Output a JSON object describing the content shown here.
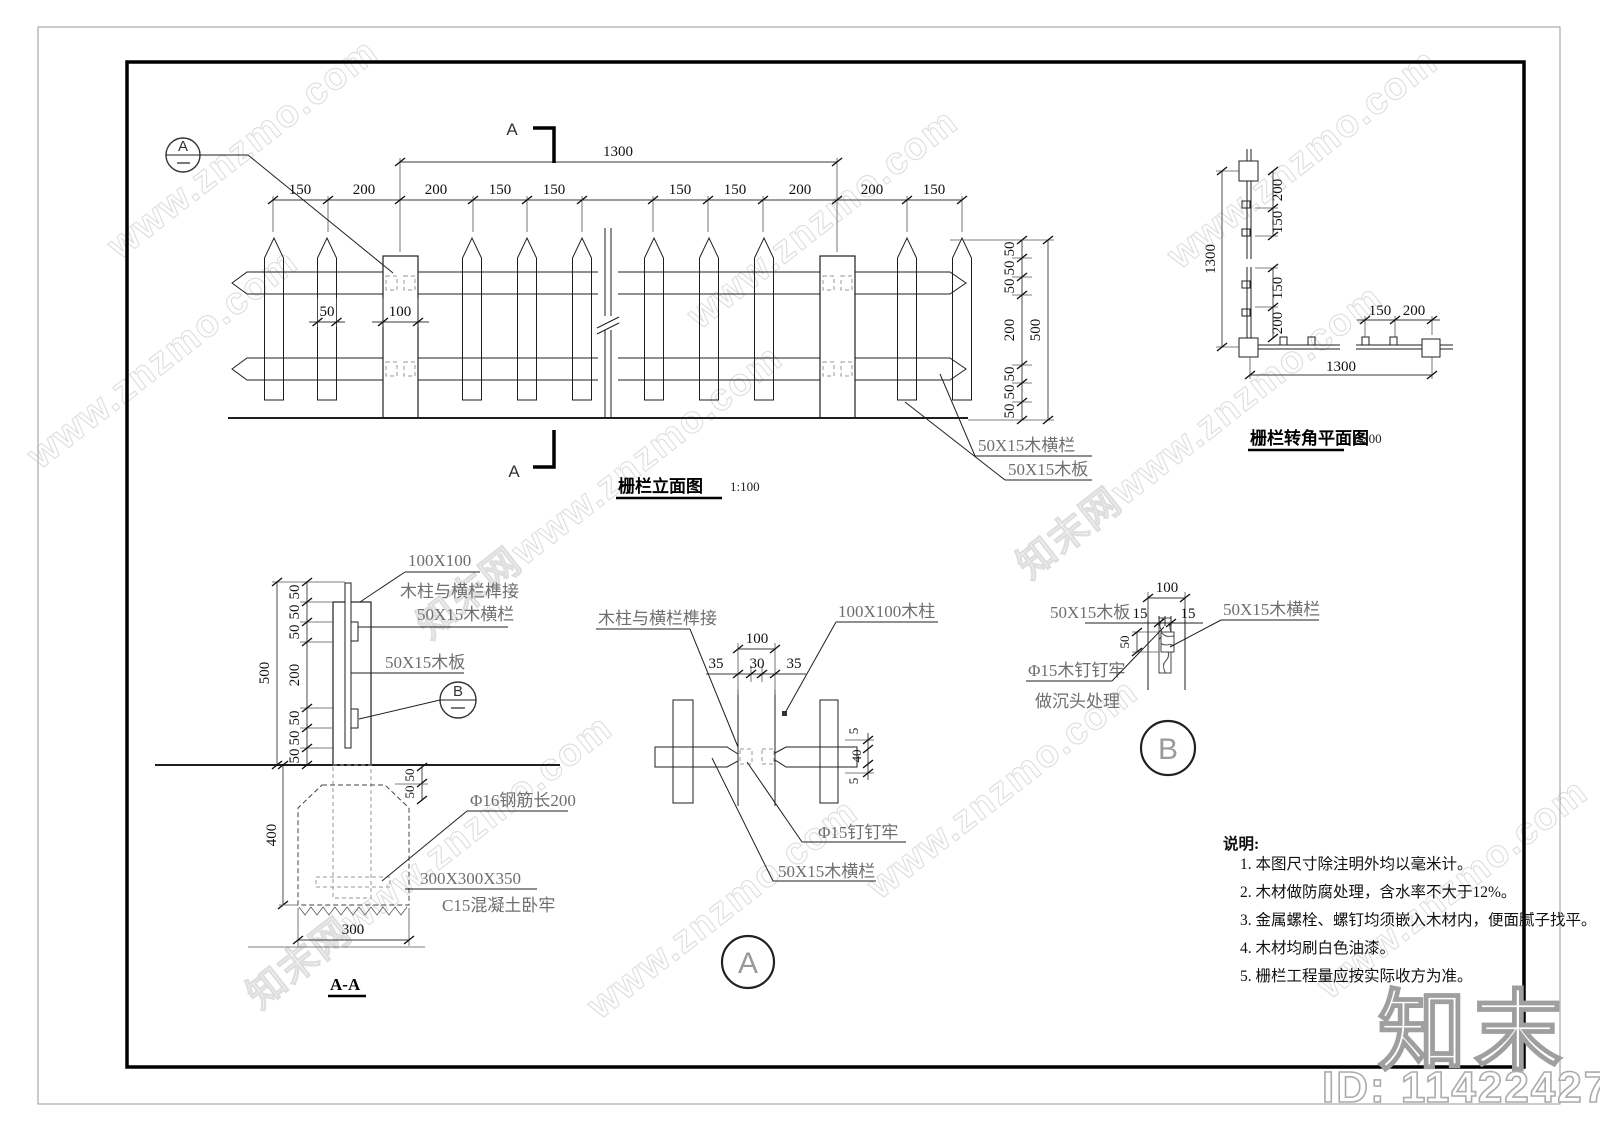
{
  "watermark": {
    "text1": "www.znzmo.com",
    "text2": "知末网www.znzmo.com",
    "logo": "知末",
    "id_label": "ID: 1142242742"
  },
  "elevation": {
    "title": "栅栏立面图",
    "scale": "1:100",
    "dim_overall_w": "1300",
    "top_dims": [
      "150",
      "200",
      "200",
      "150",
      "150",
      "150",
      "150",
      "200",
      "200",
      "150"
    ],
    "dim_picket": "50",
    "dim_post": "100",
    "side_dims": [
      "50",
      "50",
      "50",
      "200",
      "50",
      "50",
      "50"
    ],
    "dim_overall_h": "500",
    "label_rail": "50X15木横栏",
    "label_board": "50X15木板",
    "section_letter": "A",
    "callout_letter": "A",
    "callout_dash": "—"
  },
  "corner_plan": {
    "title": "栅栏转角平面图",
    "scale": "1:200",
    "dim_overall_v": "1300",
    "v_dims": [
      "200",
      "150",
      "150",
      "200"
    ],
    "h_dims": [
      "150",
      "200"
    ],
    "dim_overall_h": "1300"
  },
  "section_aa": {
    "title": "A-A",
    "side_dims": [
      "50",
      "50",
      "50",
      "200",
      "50",
      "50",
      "50"
    ],
    "dim_overall_h": "500",
    "below_dims": [
      "50",
      "50"
    ],
    "dim_depth": "400",
    "dim_width": "300",
    "label_post": "100X100",
    "label_joint": "木柱与横栏榫接",
    "label_rail": "50X15木横栏",
    "label_board": "50X15木板",
    "label_rebar": "Φ16钢筋长200",
    "label_footing_size": "300X300X350",
    "label_footing": "C15混凝土卧牢",
    "callout_letter": "B",
    "callout_dash": "—"
  },
  "detail_a": {
    "letter": "A",
    "label_joint": "木柱与横栏榫接",
    "label_post": "100X100木柱",
    "dim_top": "100",
    "dim_sub": [
      "35",
      "30",
      "35"
    ],
    "dim_side": [
      "5",
      "40",
      "5"
    ],
    "label_nail": "Φ15钉钉牢",
    "label_rail": "50X15木横栏"
  },
  "detail_b": {
    "letter": "B",
    "label_board": "50X15木板",
    "dim_top": "100",
    "dim_15l": "15",
    "dim_15r": "15",
    "dim_50": "50",
    "label_rail": "50X15木横栏",
    "label_nail_1": "Φ15木钉钉牢",
    "label_nail_2": "做沉头处理"
  },
  "notes": {
    "heading": "说明:",
    "items": [
      "1. 本图尺寸除注明外均以毫米计。",
      "2. 木材做防腐处理，含水率不大于12%。",
      "3. 金属螺栓、螺钉均须嵌入木材内，便面腻子找平。",
      "4. 木材均刷白色油漆。",
      "5. 栅栏工程量应按实际收方为准。"
    ]
  }
}
